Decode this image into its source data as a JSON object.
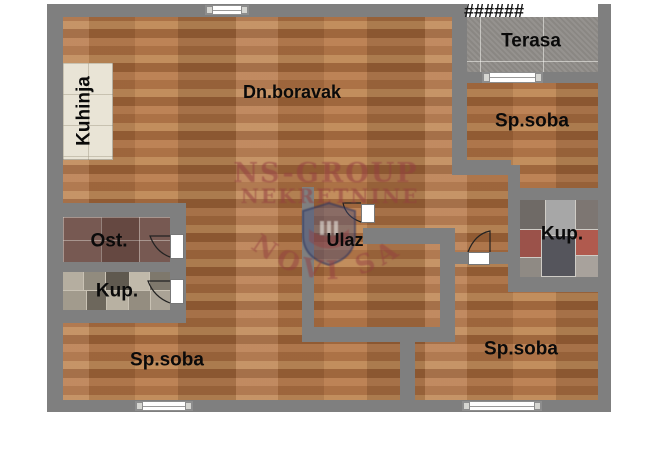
{
  "plan": {
    "colors": {
      "wall": "#7f7f7f",
      "wood": "#b0744a",
      "terrace": "#918e8a",
      "kitchen_tile": "#e9e4d6",
      "ost_tile": "#6f4f47",
      "label": "#0a0a0a",
      "watermark": "rgba(148,62,64,0.55)"
    },
    "hatch_marks": "######",
    "rooms": {
      "kuhinja": {
        "label": "Kuhinja"
      },
      "dn_boravak": {
        "label": "Dn.boravak"
      },
      "terasa": {
        "label": "Terasa"
      },
      "sp_soba_top_right": {
        "label": "Sp.soba"
      },
      "ost": {
        "label": "Ost."
      },
      "kup_left": {
        "label": "Kup."
      },
      "kup_right": {
        "label": "Kup."
      },
      "ulaz": {
        "label": "Ulaz"
      },
      "sp_soba_bottom_left": {
        "label": "Sp.soba"
      },
      "sp_soba_bottom_right": {
        "label": "Sp.soba"
      }
    },
    "watermark": {
      "line1": "NS-GROUP",
      "line2": "NEKRETNINE",
      "arc_text": "NOVI SAD"
    }
  }
}
